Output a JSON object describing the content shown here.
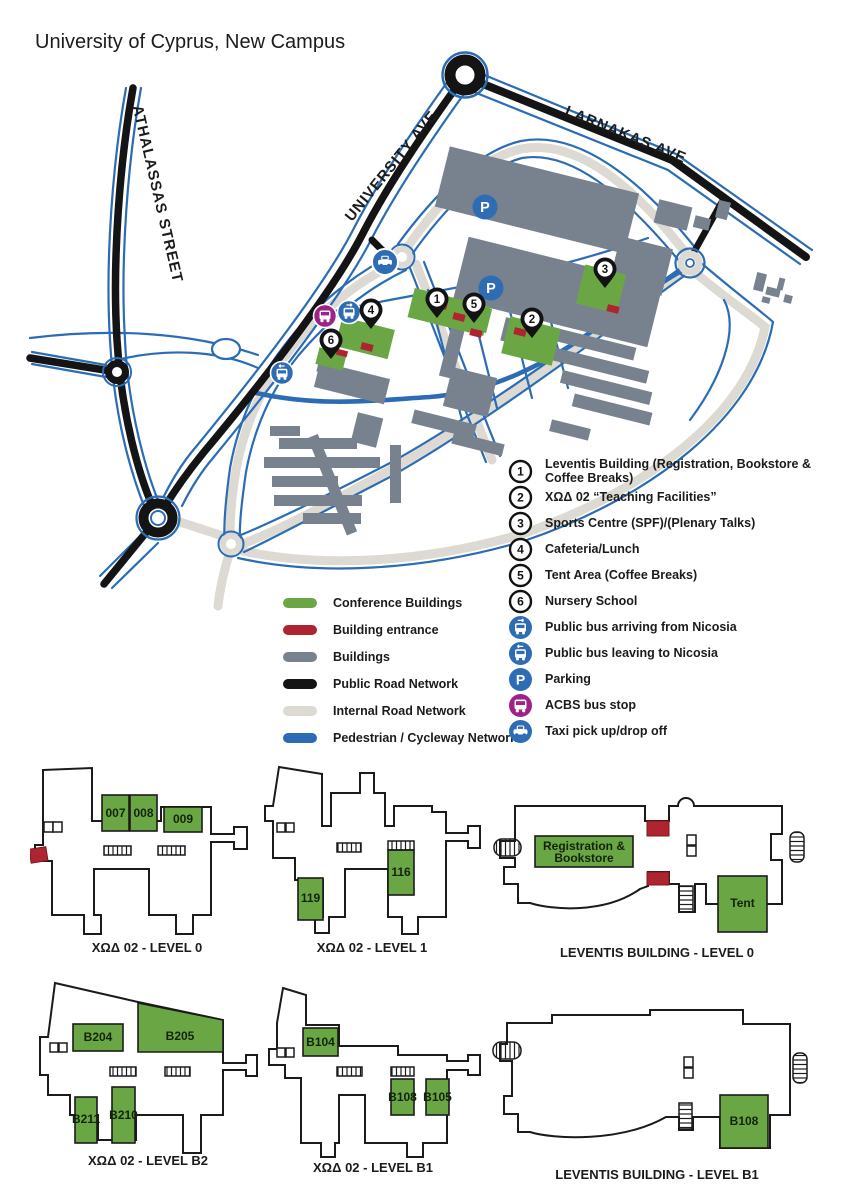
{
  "title": "University of Cyprus, New Campus",
  "map": {
    "streets": {
      "athalassas": "ATHALASSAS STREET",
      "university": "UNIVERSITY AVE",
      "larnakas": "LARNAKAS AVE"
    },
    "parking_letter": "P",
    "markers": {
      "m1": "1",
      "m2": "2",
      "m3": "3",
      "m4": "4",
      "m5": "5",
      "m6": "6"
    }
  },
  "legend_left": {
    "items": [
      {
        "label": "Conference Buildings",
        "color": "#6aa744"
      },
      {
        "label": "Building entrance",
        "color": "#ae2431"
      },
      {
        "label": "Buildings",
        "color": "#78828e"
      },
      {
        "label": "Public Road Network",
        "color": "#141414"
      },
      {
        "label": "Internal Road Network",
        "color": "#dcdad2"
      },
      {
        "label": "Pedestrian / Cycleway Network",
        "color": "#2b6cb5"
      }
    ]
  },
  "legend_right": {
    "items": [
      {
        "symbol": "1",
        "label": "Leventis Building (Registration, Bookstore & Coffee Breaks)"
      },
      {
        "symbol": "2",
        "label": "ΧΩΔ 02 “Teaching Facilities”"
      },
      {
        "symbol": "3",
        "label": "Sports Centre (SPF)/(Plenary Talks)"
      },
      {
        "symbol": "4",
        "label": "Cafeteria/Lunch"
      },
      {
        "symbol": "5",
        "label": "Tent Area (Coffee Breaks)"
      },
      {
        "symbol": "6",
        "label": "Nursery School"
      },
      {
        "symbol": "bus-arriving",
        "label": "Public bus arriving from Nicosia"
      },
      {
        "symbol": "bus-leaving",
        "label": "Public bus leaving to Nicosia"
      },
      {
        "symbol": "parking",
        "label": "Parking"
      },
      {
        "symbol": "acbs",
        "label": "ACBS bus stop"
      },
      {
        "symbol": "taxi",
        "label": "Taxi pick up/drop off"
      }
    ]
  },
  "floor_plans": [
    {
      "caption": "ΧΩΔ 02 - LEVEL 0",
      "rooms": [
        {
          "name": "007"
        },
        {
          "name": "008"
        },
        {
          "name": "009"
        }
      ]
    },
    {
      "caption": "ΧΩΔ 02 - LEVEL 1",
      "rooms": [
        {
          "name": "119"
        },
        {
          "name": "116"
        }
      ]
    },
    {
      "caption": "LEVENTIS BUILDING  - LEVEL 0",
      "rooms": [
        {
          "name": "Registration & Bookstore",
          "line1": "Registration &",
          "line2": "Bookstore"
        },
        {
          "name": "Tent"
        }
      ]
    },
    {
      "caption": "ΧΩΔ 02 - LEVEL B2",
      "rooms": [
        {
          "name": "B204"
        },
        {
          "name": "B205"
        },
        {
          "name": "B211"
        },
        {
          "name": "B210"
        }
      ]
    },
    {
      "caption": "ΧΩΔ 02 - LEVEL B1",
      "rooms": [
        {
          "name": "B104"
        },
        {
          "name": "B108"
        },
        {
          "name": "B105"
        }
      ]
    },
    {
      "caption": "LEVENTIS BUILDING  - LEVEL B1",
      "rooms": [
        {
          "name": "B108"
        }
      ]
    }
  ],
  "colors": {
    "conference_green": "#6aa744",
    "entrance_red": "#ae2431",
    "building_gray": "#78828e",
    "road_black": "#141414",
    "internal_road": "#dcdad2",
    "pedestrian_blue": "#2b6cb5",
    "transit_blue": "#2e6db4",
    "acbs_magenta": "#9e2288"
  }
}
